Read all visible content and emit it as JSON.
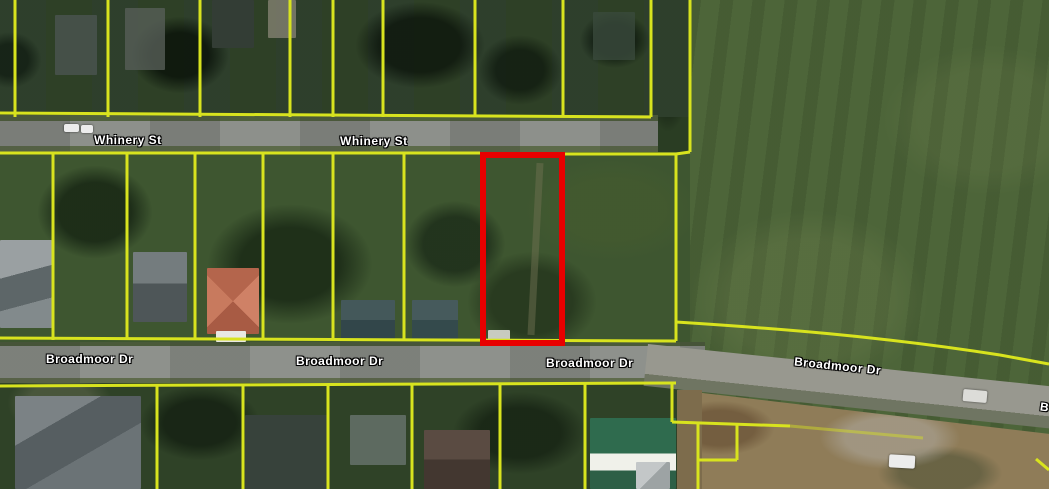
{
  "map": {
    "description": "aerial parcel map",
    "streets": {
      "whinery": "Whinery St",
      "broadmoor": "Broadmoor Dr",
      "partial_edge_label": "B"
    }
  },
  "colors": {
    "parcel_line": "#d8e31e",
    "selected_parcel": "#e80000",
    "road_surface": "#8d908b",
    "field_green": "#4d6539",
    "label_text": "#ffffff",
    "label_outline": "#000000"
  }
}
